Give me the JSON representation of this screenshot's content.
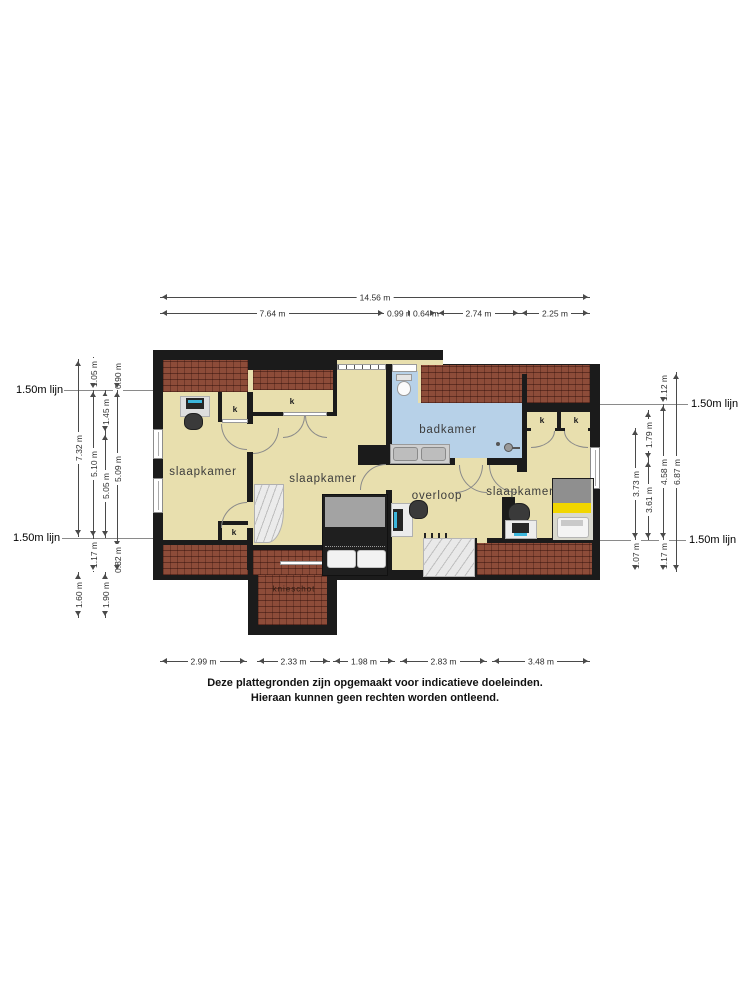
{
  "rooms": {
    "bedroom_left": "slaapkamer",
    "bedroom_middle": "slaapkamer",
    "bedroom_right": "slaapkamer",
    "bathroom": "badkamer",
    "landing": "overloop",
    "knee_wall": "knieschot",
    "closet": "k"
  },
  "reference_line": "1.50m lijn",
  "dimensions": {
    "top_total": "14.56 m",
    "top": [
      "7.64 m",
      "0.99 m",
      "0.64 m",
      "2.74 m",
      "2.25 m"
    ],
    "bottom": [
      "2.99 m",
      "2.33 m",
      "1.98 m",
      "2.83 m",
      "3.48 m"
    ],
    "left_col1": [
      "7.32 m",
      "1.60 m"
    ],
    "left_col2": [
      "1.05 m",
      "5.10 m",
      "1.17 m"
    ],
    "left_col3": [
      "1.45 m",
      "5.05 m",
      "1.90 m"
    ],
    "left_col4": [
      "0.90 m",
      "5.09 m",
      "0.82 m"
    ],
    "right_col1": [
      "3.73 m",
      "1.07 m"
    ],
    "right_col2": [
      "1.79 m",
      "3.61 m"
    ],
    "right_col3": [
      "1.12 m",
      "4.58 m",
      "1.17 m"
    ],
    "right_col4": [
      "6.87 m"
    ]
  },
  "disclaimer": [
    "Deze plattegronden zijn opgemaakt voor indicatieve doeleinden.",
    "Hieraan kunnen geen rechten worden ontleend."
  ],
  "palette": {
    "wall": "#1b1b1b",
    "floor": "#e8dfae",
    "brick_roof": "#8d4c39",
    "bathroom_blue": "#b7d1e8",
    "bed_yellow": "#f1d600",
    "stairs_gray": "#e9e9e9",
    "screen_cyan": "#3cb6dc"
  }
}
